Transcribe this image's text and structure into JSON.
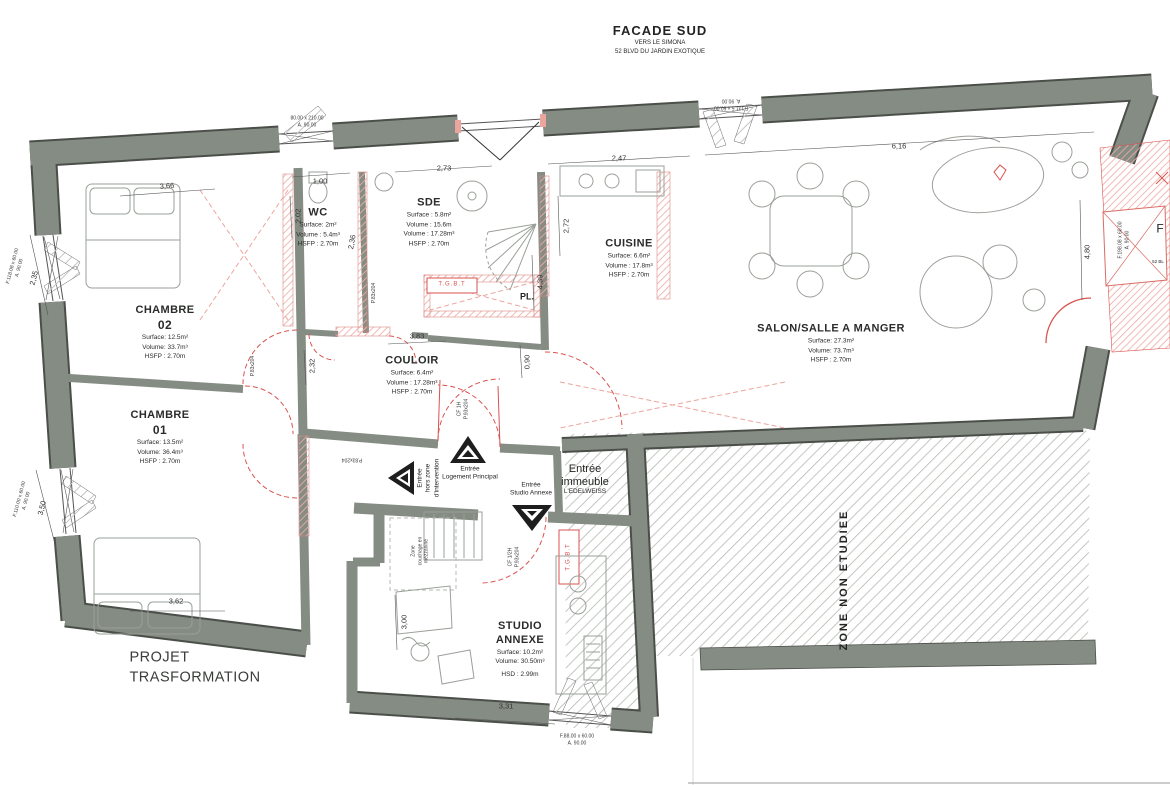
{
  "colors": {
    "wall": "#858c83",
    "wall_dark": "#4b4f49",
    "red": "#d9534f",
    "red_hatch": "#eba49e",
    "gray_hatch": "#c3c7c1",
    "text": "#232523"
  },
  "facade": {
    "title": "FACADE SUD",
    "sub1": "VERS LE SIMONA",
    "sub2": "52 BLVD DU JARDIN EXOTIQUE"
  },
  "project": {
    "line1": "PROJET",
    "line2": "TRASFORMATION"
  },
  "rooms": {
    "chambre02": {
      "name": "CHAMBRE",
      "number": "02",
      "surface": "Surface: 12.5m²",
      "volume": "Volume: 33.7m³",
      "height": "HSFP : 2.70m"
    },
    "chambre01": {
      "name": "CHAMBRE",
      "number": "01",
      "surface": "Surface: 13.5m²",
      "volume": "Volume: 36.4m³",
      "height": "HSFP : 2.70m"
    },
    "wc": {
      "name": "WC",
      "surface": "Surface: 2m²",
      "volume": "Volume : 5.4m³",
      "height": "HSFP : 2.70m"
    },
    "sde": {
      "name": "SDE",
      "surface": "Surface : 5.8m²",
      "volume": "Volume : 15.6m",
      "volume2": "Volume : 17.28m³",
      "height": "HSFP : 2.70m"
    },
    "couloir": {
      "name": "COULOIR",
      "surface": "Surface: 6.4m²",
      "volume": "Volume : 17.28m³",
      "height": "HSFP : 2.70m"
    },
    "cuisine": {
      "name": "CUISINE",
      "surface": "Surface: 6.6m²",
      "volume": "Volume : 17.8m³",
      "height": "HSFP : 2.70m"
    },
    "salon": {
      "name": "SALON/SALLE A MANGER",
      "surface": "Surface: 27.3m²",
      "volume": "Volume: 73.7m³",
      "height": "HSFP : 2.70m"
    },
    "studio": {
      "name1": "STUDIO",
      "name2": "ANNEXE",
      "surface": "Surface: 10.2m²",
      "volume": "Volume: 30.50m³",
      "height": "HSD : 2.99m"
    }
  },
  "zones": {
    "non_etudiee": "ZONE NON ETUDIEE",
    "placard": "PL.",
    "tgbt": "T.G.B.T",
    "mezzanine1": "Zone",
    "mezzanine2": "couchage en",
    "mezzanine3": "mezzanine"
  },
  "entries": {
    "hors_zone": {
      "l1": "Entrée",
      "l2": "hors zone",
      "l3": "d'intervention"
    },
    "principal": {
      "l1": "Entrée",
      "l2": "Logement Principal"
    },
    "studio": {
      "l1": "Entrée",
      "l2": "Studio Annexe"
    },
    "immeuble": {
      "l1": "Entrée",
      "l2": "immeuble",
      "l3": "L'EDELWEISS"
    }
  },
  "doors": {
    "cf1h": "CF 1H",
    "cf1h_size": "P.93x204",
    "cf12h": "CF 1/2H",
    "cf12h_size": "P.93x204",
    "p83a": "P.83x204",
    "p83b": "P.83x204",
    "p83c": "P.83x204"
  },
  "dimensions": {
    "d100": "1,00",
    "d273": "2,73",
    "d247": "2,47",
    "d616": "6,16",
    "d366": "3,66",
    "d202": "2,02",
    "d236": "2,36",
    "d235": "2,35",
    "d350": "3,50",
    "d232": "2,32",
    "d383": "3,83",
    "d272": "2,72",
    "d439": "4,39",
    "d090": "0,90",
    "d480": "4,80",
    "d362": "3,62",
    "d300": "3,00",
    "d331": "3,31"
  },
  "windows": {
    "top_left1": "80.00 x 210.00",
    "top_left2": "A. 90.00",
    "top_right1": "F.131.5 x 60.00",
    "top_right2": "A. 90.00",
    "left_upper1": "F.118.08 x 60.00",
    "left_upper2": "A. 90.00",
    "left_lower1": "F.110.00 x 60.00",
    "left_lower2": "A. 90.00",
    "bottom1": "F.88.00 x 60.00",
    "bottom2": "A. 90.00",
    "right1": "F.198.08 x 60.00",
    "right2": "A. 90.00"
  },
  "edge": {
    "f": "F",
    "addr": "52 BL"
  }
}
